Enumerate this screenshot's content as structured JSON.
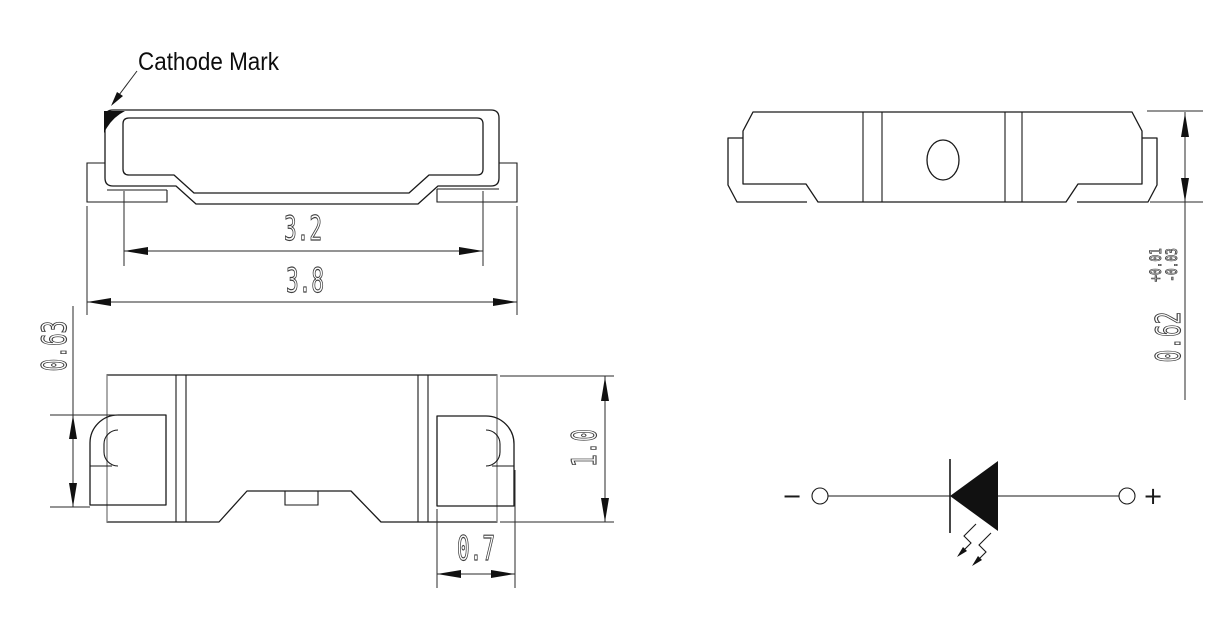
{
  "drawing": {
    "cathode_mark_label": "Cathode Mark",
    "dims": {
      "inner_width": "3.2",
      "overall_width": "3.8",
      "lead_height": "0.63",
      "body_height": "1.0",
      "lead_width": "0.7",
      "thickness": "0.62",
      "thickness_tol_plus": "+0.01",
      "thickness_tol_minus": "-0.03"
    },
    "polarity": {
      "minus": "−",
      "plus": "+"
    }
  }
}
